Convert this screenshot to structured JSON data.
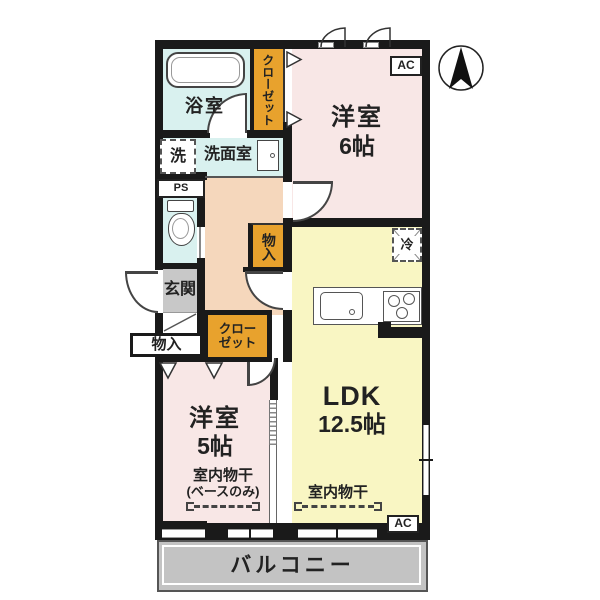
{
  "plan": {
    "type": "apartment-floor-plan",
    "colors": {
      "wall": "#1a1a1a",
      "western_room": "#f8e7e6",
      "ldk": "#f9f6c3",
      "wet_area": "#d9f1ef",
      "hallway": "#f5d7bc",
      "closet": "#e8a22d",
      "entry": "#c8c8c8",
      "balcony": "#c3c3c3"
    },
    "rooms": {
      "bath": {
        "label": "浴室"
      },
      "washroom": {
        "label": "洗面室"
      },
      "entry": {
        "label": "玄関"
      },
      "bedroom6": {
        "name": "洋室",
        "size": "6帖"
      },
      "bedroom5": {
        "name": "洋室",
        "size": "5帖"
      },
      "ldk": {
        "name": "LDK",
        "size": "12.5帖"
      },
      "balcony": {
        "label": "バルコニー"
      }
    },
    "fixtures": {
      "closet_top": {
        "label": "クローゼット"
      },
      "closet_mid": {
        "line1": "クロー",
        "line2": "ゼット"
      },
      "storage_hall": {
        "label": "物入"
      },
      "storage_left": {
        "label": "物入"
      },
      "washer_pan": {
        "label": "洗"
      },
      "pipe_space": {
        "label": "PS"
      },
      "fridge_space": {
        "label": "冷"
      },
      "ac_top": {
        "label": "AC"
      },
      "ac_bottom": {
        "label": "AC"
      },
      "drying_bedroom5": {
        "label": "室内物干",
        "note": "(ベースのみ)"
      },
      "drying_ldk": {
        "label": "室内物干"
      }
    }
  }
}
